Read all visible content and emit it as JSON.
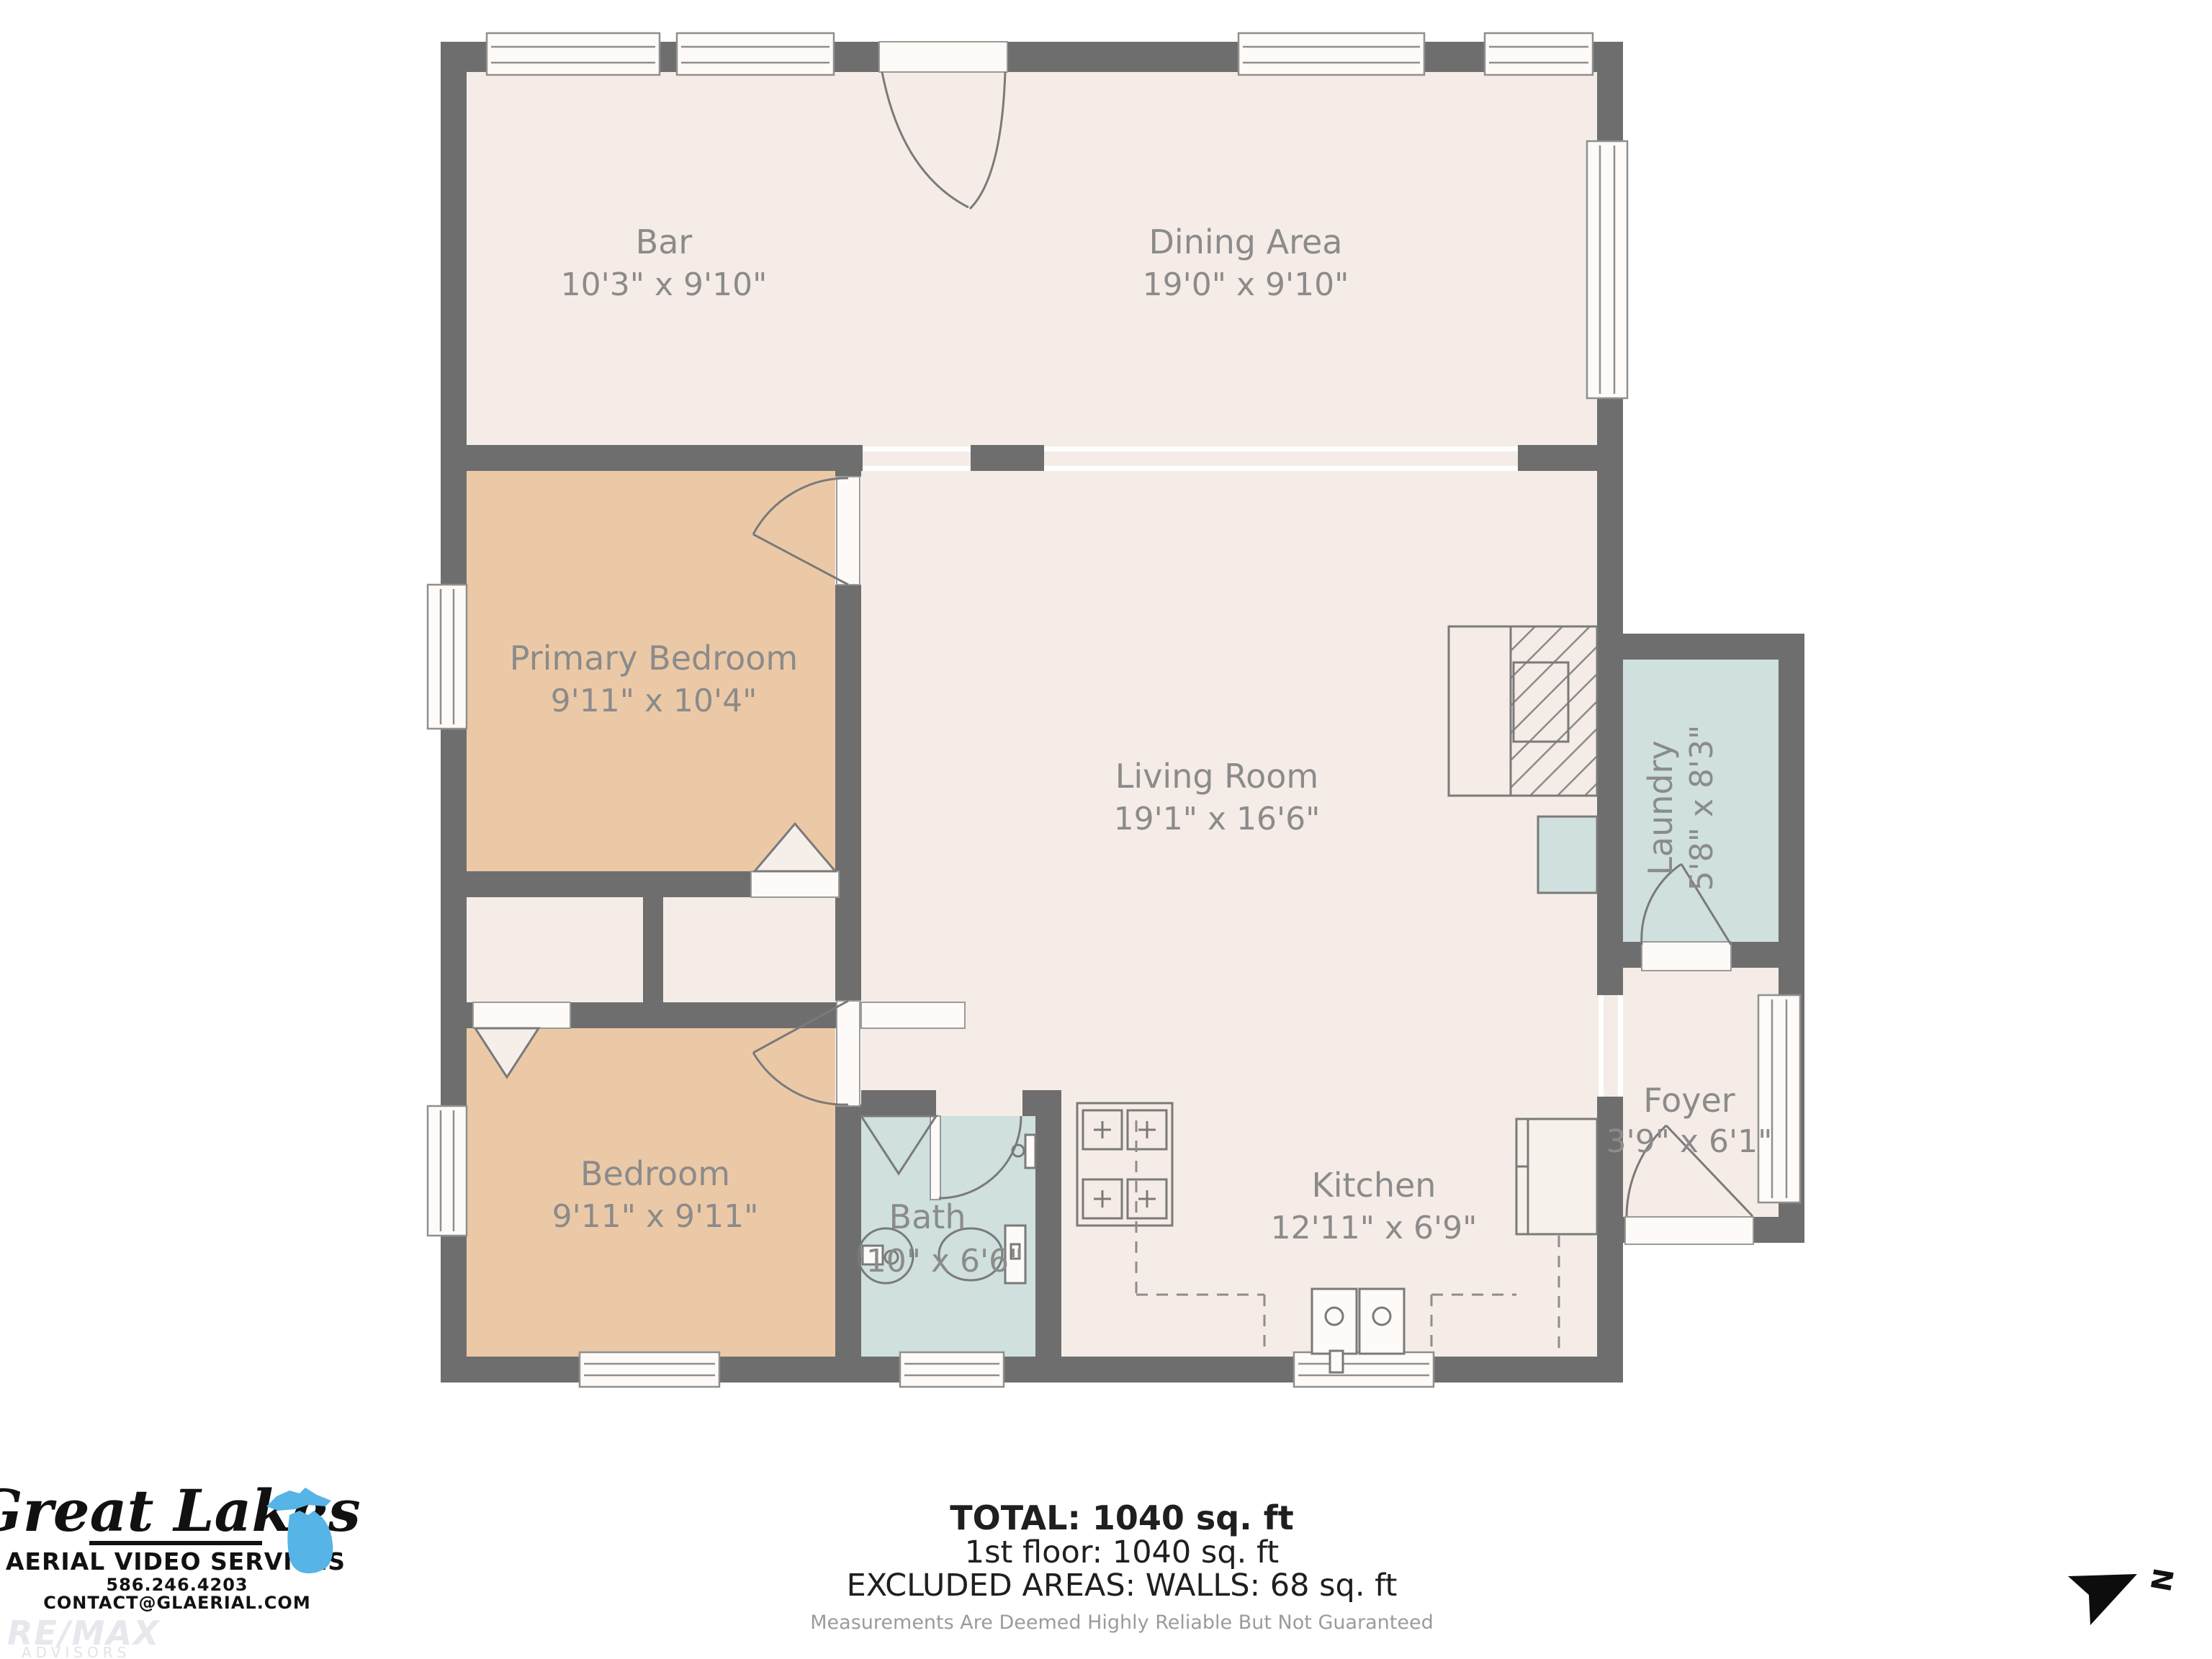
{
  "plan": {
    "rooms": {
      "bar": {
        "name": "Bar",
        "dims": "10'3\" x 9'10\""
      },
      "dining": {
        "name": "Dining Area",
        "dims": "19'0\" x 9'10\""
      },
      "primary_bedroom": {
        "name": "Primary Bedroom",
        "dims": "9'11\" x 10'4\""
      },
      "living_room": {
        "name": "Living Room",
        "dims": "19'1\" x 16'6\""
      },
      "laundry": {
        "name": "Laundry",
        "dims": "5'8\" x 8'3\""
      },
      "bedroom": {
        "name": "Bedroom",
        "dims": "9'11\" x 9'11\""
      },
      "bath": {
        "name": "Bath",
        "dims": "'10\" x 6'6\""
      },
      "kitchen": {
        "name": "Kitchen",
        "dims": "12'11\" x 6'9\""
      },
      "foyer": {
        "name": "Foyer",
        "dims": "3'9\" x 6'1\""
      }
    }
  },
  "summary": {
    "total": "TOTAL: 1040 sq. ft",
    "floor1": "1st floor: 1040 sq. ft",
    "excluded": "EXCLUDED AREAS: WALLS: 68 sq. ft",
    "disclaimer": "Measurements Are Deemed Highly Reliable But Not Guaranteed"
  },
  "logo": {
    "name": "Great Lakes",
    "subtitle": "AERIAL VIDEO SERVICES",
    "phone": "586.246.4203",
    "email": "CONTACT@GLAERIAL.COM"
  },
  "watermark": {
    "brand": "RE/MAX",
    "sub": "ADVISORS"
  },
  "compass": {
    "north_label": "N"
  },
  "colors": {
    "wall": "#6e6e6e",
    "floor": "#f5ece7",
    "bedroom_floor": "#ecc9a6",
    "wet_floor": "#cfe0de",
    "label_text": "#8b8b8b",
    "michigan_blue": "#56b4e6"
  }
}
